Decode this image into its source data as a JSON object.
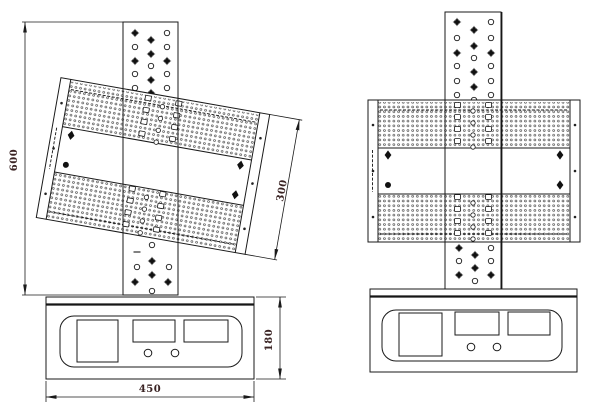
{
  "title": "TV mount bracket technical drawing - tilted and straight views",
  "dims": {
    "overall_height": "600",
    "plate_height": "300",
    "base_width": "450",
    "base_height": "180"
  },
  "colors": {
    "line": "#1a1a1a",
    "dim_text": "#3a2323",
    "dots": "#3d3d3d",
    "background": "#ffffff"
  },
  "figures": {
    "left": {
      "name": "tilted-view",
      "tilt_deg": 10,
      "column_top_holes": [
        [
          "x",
          135,
          33
        ],
        [
          "o",
          135,
          47
        ],
        [
          "x",
          135,
          61
        ],
        [
          "o",
          135,
          74
        ],
        [
          "o",
          135,
          88
        ],
        [
          "x",
          151,
          40
        ],
        [
          "x",
          151,
          54
        ],
        [
          "o",
          151,
          66
        ],
        [
          "x",
          151,
          80
        ],
        [
          "x",
          151,
          93
        ],
        [
          "o",
          167,
          33
        ],
        [
          "o",
          167,
          47
        ],
        [
          "x",
          167,
          61
        ],
        [
          "o",
          167,
          74
        ],
        [
          "o",
          167,
          88
        ]
      ],
      "column_bottom_holes": [
        [
          "o",
          152,
          245
        ],
        [
          "dash",
          137,
          252
        ],
        [
          "x",
          152,
          261
        ],
        [
          "o",
          137,
          267
        ],
        [
          "o",
          169,
          267
        ],
        [
          "x",
          152,
          275
        ],
        [
          "x",
          135,
          282
        ],
        [
          "x",
          168,
          282
        ],
        [
          "o",
          152,
          291
        ]
      ]
    },
    "right": {
      "name": "straight-view",
      "tilt_deg": 0,
      "column_top_holes": [
        [
          "x",
          457,
          22
        ],
        [
          "o",
          457,
          38
        ],
        [
          "x",
          457,
          53
        ],
        [
          "o",
          457,
          66
        ],
        [
          "o",
          457,
          81
        ],
        [
          "o",
          457,
          95
        ],
        [
          "x",
          474,
          30
        ],
        [
          "x",
          474,
          46
        ],
        [
          "o",
          474,
          58
        ],
        [
          "x",
          474,
          72
        ],
        [
          "x",
          474,
          87
        ],
        [
          "o",
          474,
          100
        ],
        [
          "o",
          491,
          22
        ],
        [
          "o",
          491,
          38
        ],
        [
          "x",
          491,
          53
        ],
        [
          "o",
          491,
          66
        ],
        [
          "o",
          491,
          81
        ],
        [
          "o",
          491,
          95
        ]
      ],
      "column_bottom_holes": [
        [
          "x",
          459,
          248
        ],
        [
          "x",
          475,
          255
        ],
        [
          "o",
          491,
          248
        ],
        [
          "o",
          459,
          261
        ],
        [
          "o",
          491,
          261
        ],
        [
          "x",
          475,
          268
        ],
        [
          "x",
          459,
          275
        ],
        [
          "x",
          491,
          275
        ],
        [
          "o",
          475,
          281
        ]
      ]
    },
    "plate": {
      "rail_holes": [
        [
          "rh",
          5,
          25
        ],
        [
          "rh",
          5,
          71
        ],
        [
          "rh",
          5,
          117
        ],
        [
          "rh",
          207,
          25
        ],
        [
          "rh",
          207,
          71
        ],
        [
          "rh",
          207,
          117
        ]
      ],
      "marks": [
        [
          "d",
          20,
          55
        ],
        [
          "d",
          192,
          55
        ],
        [
          "dot",
          20,
          85
        ],
        [
          "d",
          192,
          85
        ]
      ],
      "slots": [
        [
          "sq",
          89.5,
          5
        ],
        [
          "sq",
          120.5,
          5
        ],
        [
          "sq",
          89.5,
          17
        ],
        [
          "sq",
          120.5,
          17
        ],
        [
          "sq",
          89.5,
          29
        ],
        [
          "sq",
          120.5,
          29
        ],
        [
          "sq",
          89.5,
          41
        ],
        [
          "sq",
          120.5,
          41
        ],
        [
          "sc",
          105,
          11
        ],
        [
          "sc",
          105,
          23
        ],
        [
          "sc",
          105,
          35
        ],
        [
          "sc",
          105,
          47
        ],
        [
          "sq",
          89.5,
          97
        ],
        [
          "sq",
          120.5,
          97
        ],
        [
          "sq",
          89.5,
          109
        ],
        [
          "sq",
          120.5,
          109
        ],
        [
          "sq",
          89.5,
          121
        ],
        [
          "sq",
          120.5,
          121
        ],
        [
          "sq",
          89.5,
          133
        ],
        [
          "sq",
          120.5,
          133
        ],
        [
          "sc",
          105,
          103
        ],
        [
          "sc",
          105,
          115
        ],
        [
          "sc",
          105,
          127
        ],
        [
          "sc",
          105,
          139
        ]
      ]
    }
  }
}
